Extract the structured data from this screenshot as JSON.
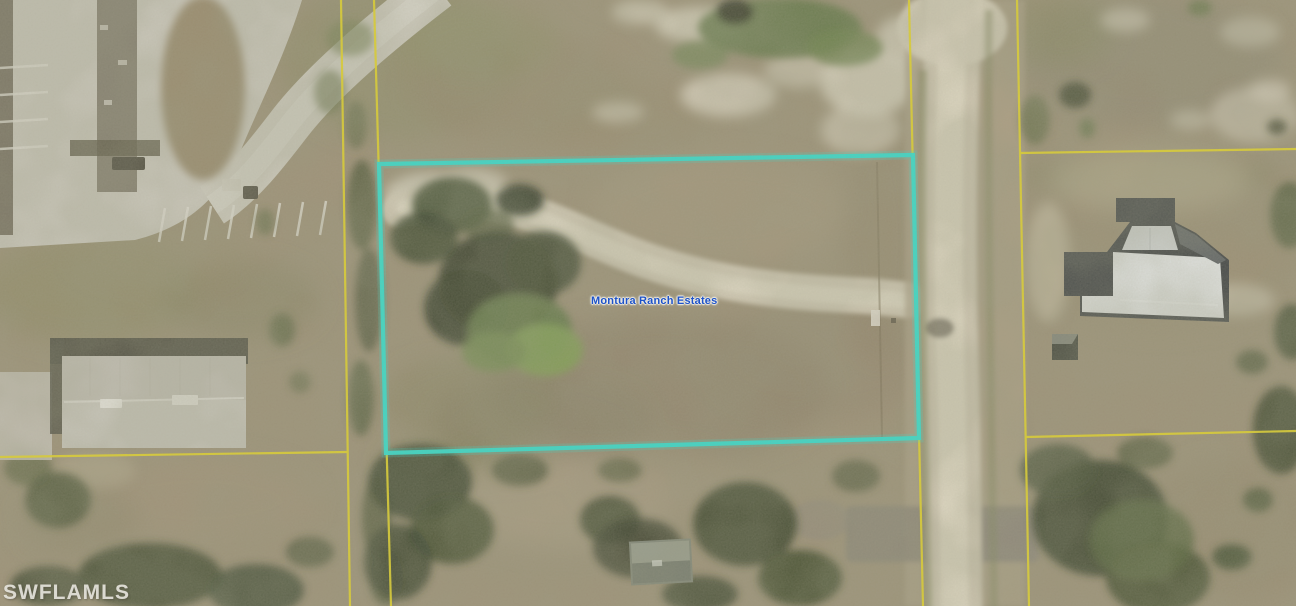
{
  "labels": {
    "parcel_label": "Montura Ranch Estates",
    "watermark": "SWFLAMLS"
  },
  "colors": {
    "property_boundary": "#38d9c8",
    "parcel_lines": "#ddd02c",
    "parcel_label_text": "#1d53c9",
    "watermark_text": "#faf8f2"
  }
}
